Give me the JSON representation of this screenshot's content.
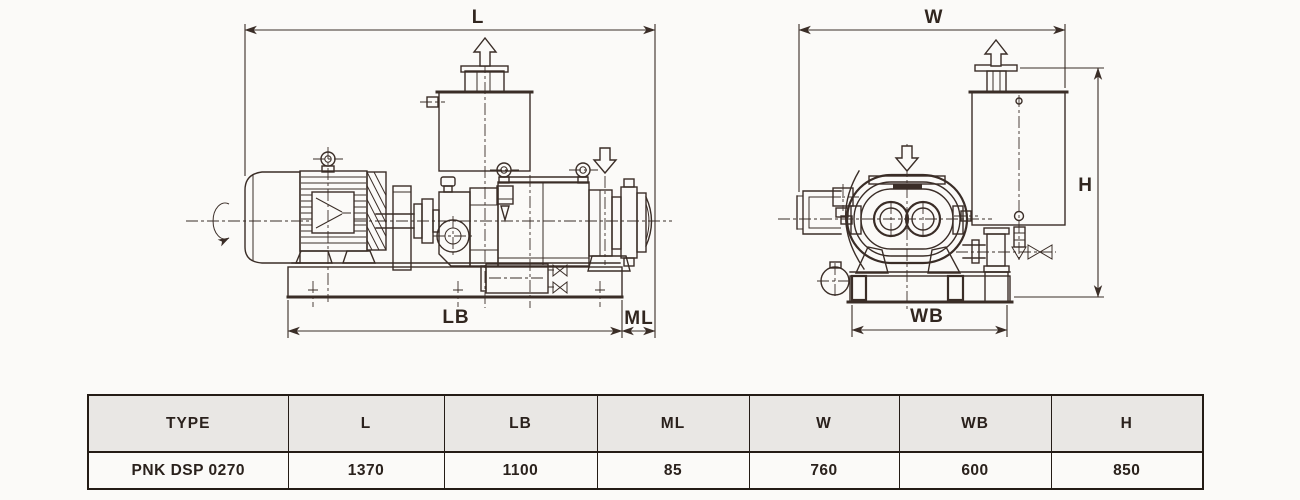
{
  "colors": {
    "line": "#3a2d27",
    "background": "#fbfaf8",
    "table_border": "#241c16",
    "table_header_bg": "#e9e7e4",
    "text": "#2a211c"
  },
  "labels": {
    "L": "L",
    "LB": "LB",
    "ML": "ML",
    "W": "W",
    "WB": "WB",
    "H": "H"
  },
  "table": {
    "headers": [
      "TYPE",
      "L",
      "LB",
      "ML",
      "W",
      "WB",
      "H"
    ],
    "row": [
      "PNK DSP 0270",
      "1370",
      "1100",
      "85",
      "760",
      "600",
      "850"
    ]
  }
}
